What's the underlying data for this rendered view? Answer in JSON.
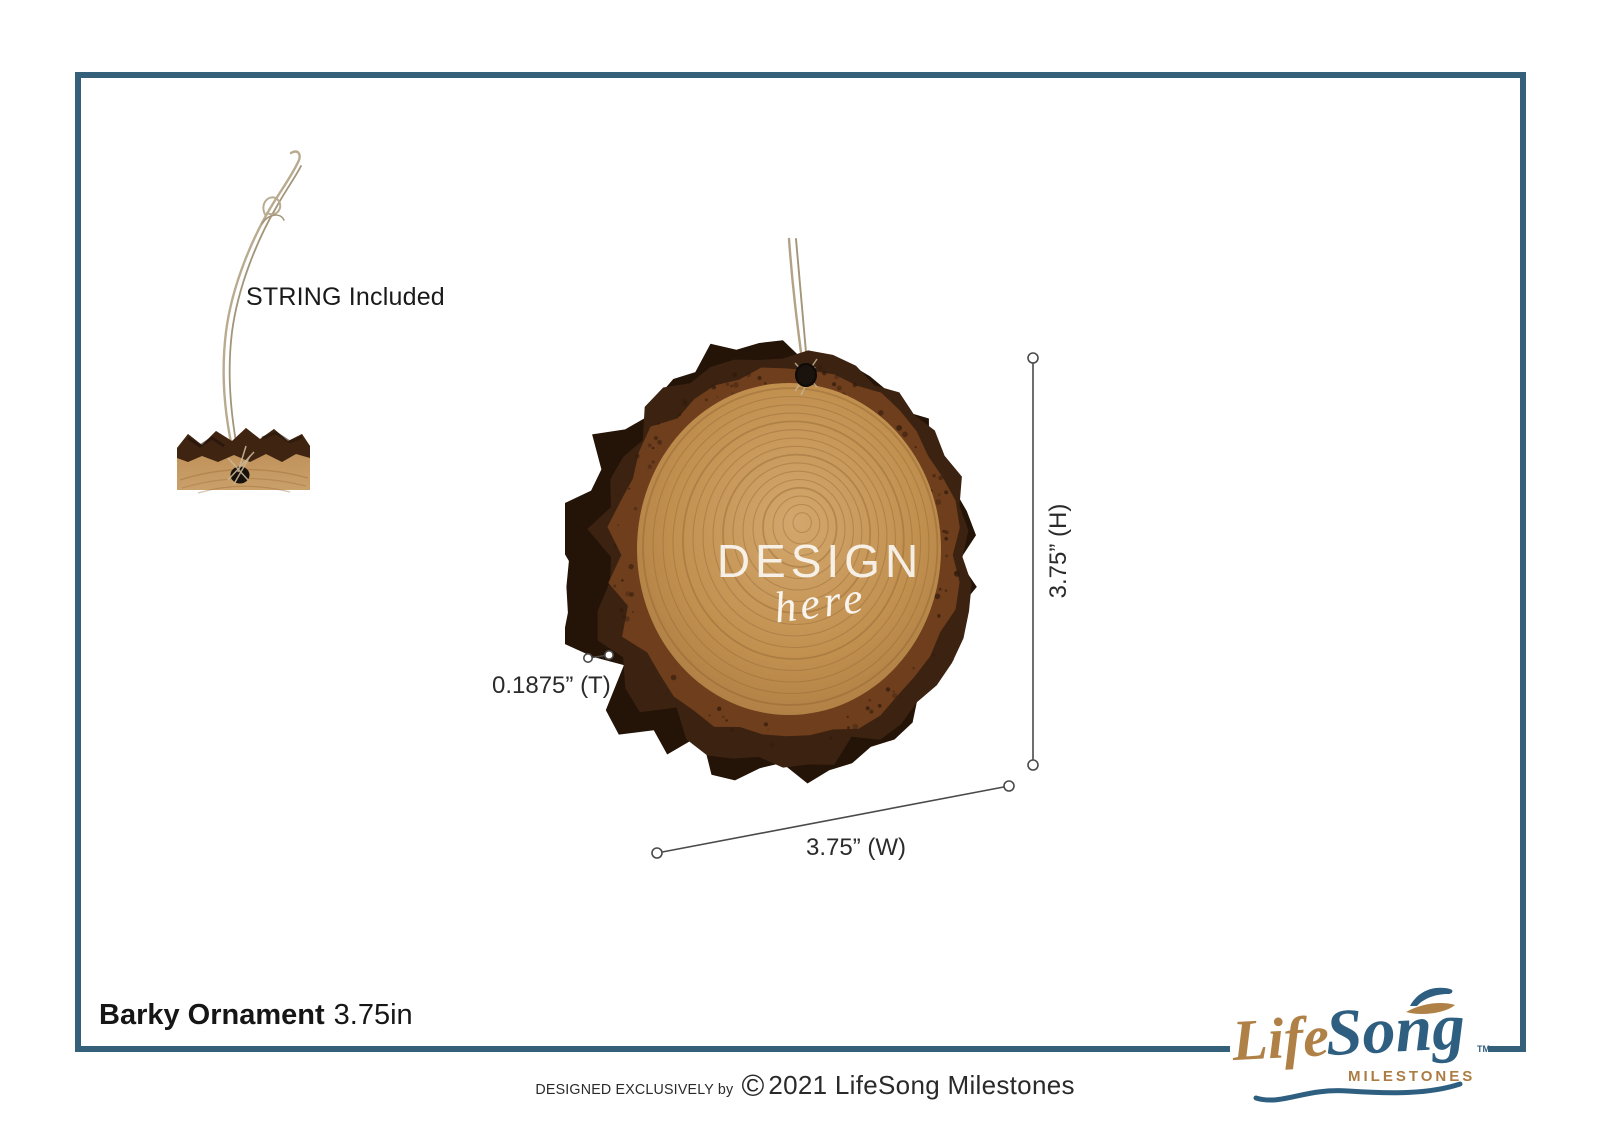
{
  "colors": {
    "frame_border": "#35607a",
    "dimension_line": "#4a4a4a",
    "text_dark": "#1a1a1a",
    "logo_gold": "#b08146",
    "logo_blue": "#2e5f80",
    "twine": "#b3a286",
    "bark_dark": "#241407",
    "bark_mid": "#6e3e1d",
    "wood_light": "#d3a76d",
    "wood_mid": "#b5834b",
    "wood_ring": "#8d6232"
  },
  "callout": {
    "string_label": "STRING Included"
  },
  "ornament": {
    "design_line1": "DESIGN",
    "design_line2": "here"
  },
  "dimensions": {
    "height_label": "3.75” (H)",
    "width_label": "3.75” (W)",
    "thickness_label": "0.1875” (T)"
  },
  "product": {
    "name": "Barky Ornament",
    "size": "3.75in"
  },
  "footer": {
    "prefix": "DESIGNED EXCLUSIVELY by",
    "copyright_symbol": "©",
    "suffix": "2021 LifeSong Milestones"
  },
  "logo": {
    "word1": "Life",
    "word2": "Song",
    "tagline": "MILESTONES",
    "tm": "TM"
  }
}
